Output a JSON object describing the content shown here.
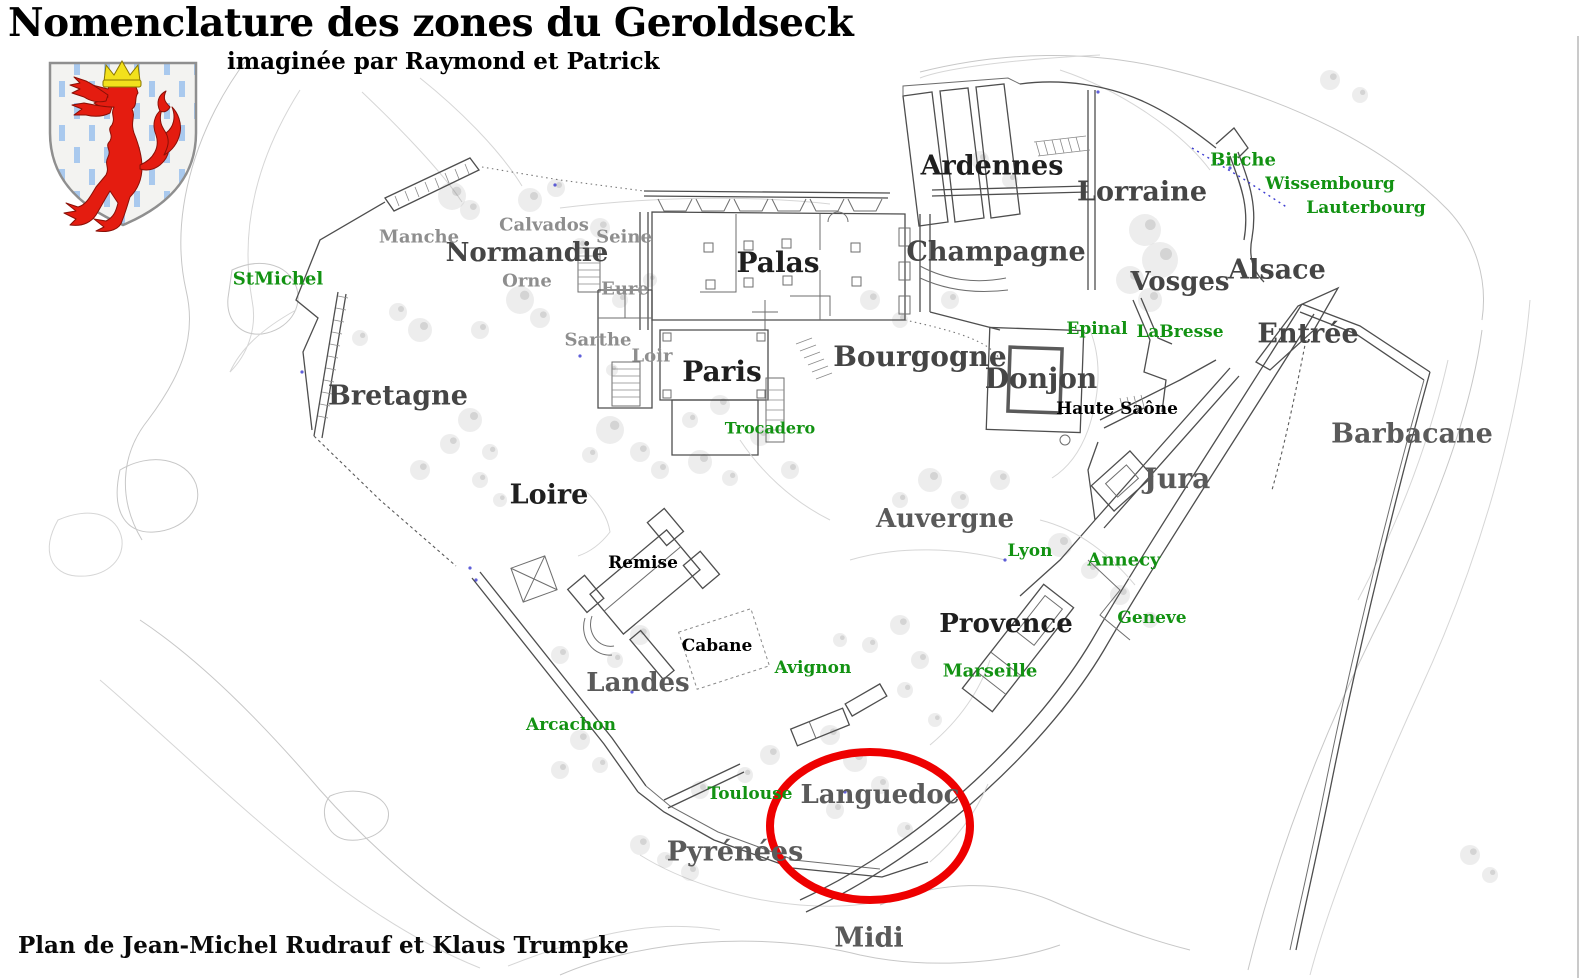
{
  "header": {
    "title": "Nomenclature des zones du Geroldseck",
    "subtitle": "imaginée par Raymond et Patrick"
  },
  "footer": {
    "credit": "Plan de Jean-Michel Rudrauf et Klaus Trumpke"
  },
  "crest": {
    "name": "geroldseck-coat-of-arms",
    "field_color": "#f3f3f1",
    "stripe_color": "#a9c9ee",
    "lion_color": "#e41c10",
    "crown_color": "#f2e11c",
    "border_color": "#8f8f8f"
  },
  "highlight": {
    "zone": "Languedoc",
    "color": "#ee0000",
    "cx": 870,
    "cy": 826,
    "rx": 100,
    "ry": 74,
    "stroke_width": 8
  },
  "legend_colors": {
    "dark_zone": "#1f1f1f",
    "major_zone": "#454545",
    "soft_zone": "#5a5a5a",
    "minor_gray": "#8e8e8e",
    "minor_black": "#000000",
    "poi_green": "#129212"
  },
  "map": {
    "labels": [
      {
        "id": "normandie",
        "text": "Normandie",
        "x": 527,
        "y": 254,
        "cls": "mid",
        "size": 26
      },
      {
        "id": "palas",
        "text": "Palas",
        "x": 778,
        "y": 264,
        "cls": "dark",
        "size": 28
      },
      {
        "id": "paris",
        "text": "Paris",
        "x": 722,
        "y": 373,
        "cls": "dark",
        "size": 28
      },
      {
        "id": "bretagne",
        "text": "Bretagne",
        "x": 398,
        "y": 397,
        "cls": "mid",
        "size": 27
      },
      {
        "id": "loire",
        "text": "Loire",
        "x": 549,
        "y": 496,
        "cls": "dark",
        "size": 27
      },
      {
        "id": "ardennes",
        "text": "Ardennes",
        "x": 992,
        "y": 167,
        "cls": "dark",
        "size": 27
      },
      {
        "id": "lorraine",
        "text": "Lorraine",
        "x": 1142,
        "y": 193,
        "cls": "mid",
        "size": 27
      },
      {
        "id": "champagne",
        "text": "Champagne",
        "x": 996,
        "y": 253,
        "cls": "mid",
        "size": 27
      },
      {
        "id": "vosges",
        "text": "Vosges",
        "x": 1180,
        "y": 283,
        "cls": "mid",
        "size": 26
      },
      {
        "id": "alsace",
        "text": "Alsace",
        "x": 1277,
        "y": 271,
        "cls": "mid",
        "size": 27
      },
      {
        "id": "entree",
        "text": "Entrée",
        "x": 1308,
        "y": 335,
        "cls": "mid",
        "size": 27
      },
      {
        "id": "bourgogne",
        "text": "Bourgogne",
        "x": 920,
        "y": 358,
        "cls": "mid",
        "size": 28
      },
      {
        "id": "donjon",
        "text": "Donjon",
        "x": 1041,
        "y": 380,
        "cls": "mid",
        "size": 28
      },
      {
        "id": "barbacane",
        "text": "Barbacane",
        "x": 1412,
        "y": 435,
        "cls": "soft",
        "size": 27
      },
      {
        "id": "jura",
        "text": "Jura",
        "x": 1177,
        "y": 480,
        "cls": "soft",
        "size": 28
      },
      {
        "id": "auvergne",
        "text": "Auvergne",
        "x": 945,
        "y": 520,
        "cls": "soft",
        "size": 26
      },
      {
        "id": "provence",
        "text": "Provence",
        "x": 1006,
        "y": 625,
        "cls": "dark",
        "size": 26
      },
      {
        "id": "landes",
        "text": "Landes",
        "x": 638,
        "y": 684,
        "cls": "soft",
        "size": 26
      },
      {
        "id": "languedoc",
        "text": "Languedoc",
        "x": 880,
        "y": 796,
        "cls": "soft",
        "size": 26
      },
      {
        "id": "pyrenees",
        "text": "Pyrénées",
        "x": 735,
        "y": 853,
        "cls": "soft",
        "size": 27
      },
      {
        "id": "midi",
        "text": "Midi",
        "x": 869,
        "y": 939,
        "cls": "soft",
        "size": 27
      },
      {
        "id": "manche",
        "text": "Manche",
        "x": 419,
        "y": 238,
        "cls": "gray",
        "size": 18
      },
      {
        "id": "calvados",
        "text": "Calvados",
        "x": 544,
        "y": 226,
        "cls": "gray",
        "size": 18
      },
      {
        "id": "seine",
        "text": "Seine",
        "x": 624,
        "y": 238,
        "cls": "gray",
        "size": 18
      },
      {
        "id": "orne",
        "text": "Orne",
        "x": 527,
        "y": 282,
        "cls": "gray",
        "size": 18
      },
      {
        "id": "eure",
        "text": "Eure",
        "x": 625,
        "y": 290,
        "cls": "gray",
        "size": 18
      },
      {
        "id": "sarthe",
        "text": "Sarthe",
        "x": 598,
        "y": 341,
        "cls": "gray",
        "size": 18
      },
      {
        "id": "loir",
        "text": "Loir",
        "x": 652,
        "y": 357,
        "cls": "gray",
        "size": 18
      },
      {
        "id": "remise",
        "text": "Remise",
        "x": 643,
        "y": 564,
        "cls": "black",
        "size": 17
      },
      {
        "id": "cabane",
        "text": "Cabane",
        "x": 717,
        "y": 647,
        "cls": "black",
        "size": 17
      },
      {
        "id": "haute-saone",
        "text": "Haute Saône",
        "x": 1117,
        "y": 410,
        "cls": "black",
        "size": 17
      },
      {
        "id": "stmichel",
        "text": "StMichel",
        "x": 278,
        "y": 280,
        "cls": "green",
        "size": 18
      },
      {
        "id": "bitche",
        "text": "Bitche",
        "x": 1243,
        "y": 161,
        "cls": "green",
        "size": 18
      },
      {
        "id": "wissembourg",
        "text": "Wissembourg",
        "x": 1330,
        "y": 185,
        "cls": "green",
        "size": 17
      },
      {
        "id": "lauterbourg",
        "text": "Lauterbourg",
        "x": 1366,
        "y": 209,
        "cls": "green",
        "size": 17
      },
      {
        "id": "epinal",
        "text": "Epinal",
        "x": 1097,
        "y": 330,
        "cls": "green",
        "size": 17
      },
      {
        "id": "labresse",
        "text": "LaBresse",
        "x": 1180,
        "y": 333,
        "cls": "green",
        "size": 17
      },
      {
        "id": "trocadero",
        "text": "Trocadero",
        "x": 770,
        "y": 429,
        "cls": "green",
        "size": 16
      },
      {
        "id": "lyon",
        "text": "Lyon",
        "x": 1030,
        "y": 552,
        "cls": "green",
        "size": 17
      },
      {
        "id": "annecy",
        "text": "Annecy",
        "x": 1124,
        "y": 561,
        "cls": "green",
        "size": 18
      },
      {
        "id": "geneve",
        "text": "Geneve",
        "x": 1152,
        "y": 619,
        "cls": "green",
        "size": 17
      },
      {
        "id": "marseille",
        "text": "Marseille",
        "x": 990,
        "y": 672,
        "cls": "green",
        "size": 18
      },
      {
        "id": "avignon",
        "text": "Avignon",
        "x": 813,
        "y": 669,
        "cls": "green",
        "size": 17
      },
      {
        "id": "arcachon",
        "text": "Arcachon",
        "x": 571,
        "y": 726,
        "cls": "green",
        "size": 17
      },
      {
        "id": "toulouse",
        "text": "Toulouse",
        "x": 750,
        "y": 795,
        "cls": "green",
        "size": 17
      }
    ]
  }
}
